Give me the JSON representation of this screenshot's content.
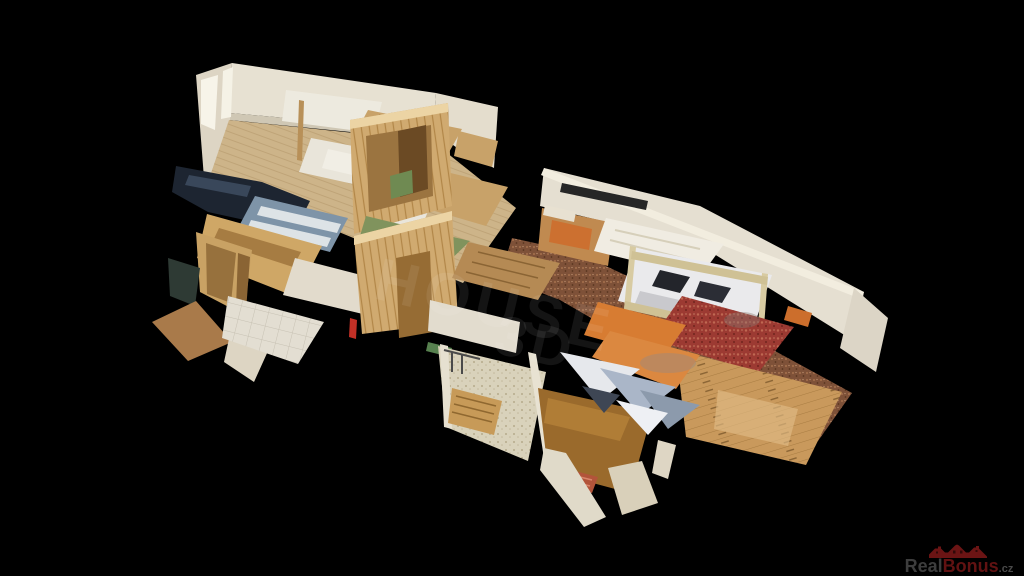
{
  "canvas": {
    "width": 1024,
    "height": 576,
    "background_color": "#000000"
  },
  "scene": {
    "type": "3d-dollhouse-cutaway-scan",
    "subject": "top-down cutaway of an apartment with bunk beds, pine-panelled walls, corridors and carpets on a black void",
    "palette": {
      "white_wall": "#e6e1d3",
      "pine_wood": "#d0aa70",
      "beige_carpet": "#cdb489",
      "plank_floor": "#c9995c",
      "red_carpet": "#9c3a32",
      "brown_speckled_carpet": "#7e5138",
      "white_bedding": "#eaeaec",
      "blue_bedding": "#7e94a8",
      "orange_accent": "#d77c32",
      "green_floor": "#80935d",
      "navy_shadow": "#1d2530",
      "terrazzo_floor": "#d9d2bb"
    }
  },
  "watermark": {
    "line1": "HOUSE",
    "line2": "3D",
    "color": "#ffffff",
    "opacity": "0.08"
  },
  "brand": {
    "name_prefix": "Real",
    "name_suffix": "Bonus",
    "tld": ".cz",
    "roof_icon_color": "#6b1414",
    "prefix_color": "#3d3d3d",
    "suffix_color": "#611212",
    "tld_color": "#4a4a4a"
  }
}
